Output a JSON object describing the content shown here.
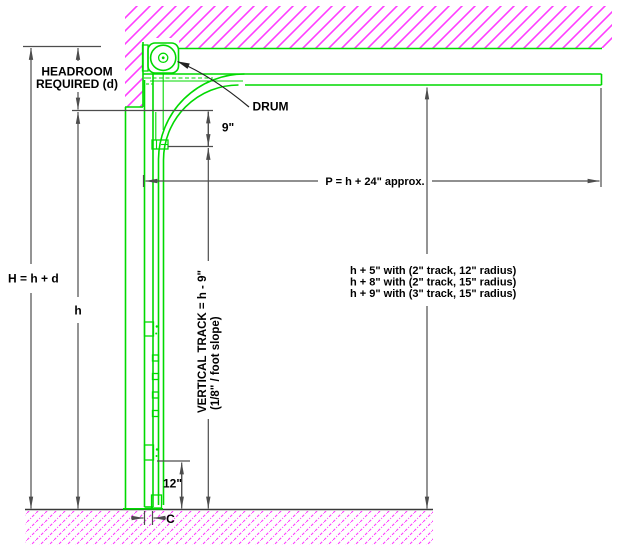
{
  "drawing": {
    "type": "sectional-door-track-headroom-diagram",
    "labels": {
      "headroom1": "HEADROOM",
      "headroom2": "REQUIRED (d)",
      "height_total": "H = h + d",
      "height_opening": "h",
      "drum": "DRUM",
      "top_offset": "9\"",
      "horizontal_track": "P = h + 24\" approx.",
      "note1": "h + 5\" with (2\" track, 12\" radius)",
      "note2": "h + 8\" with (2\" track, 15\" radius)",
      "note3": "h + 9\" with (3\" track, 15\" radius)",
      "vertical_track": "VERTICAL TRACK = h - 9\"",
      "vertical_track_slope": "(1/8\" / foot slope)",
      "bottom_offset": "12\"",
      "clearance": "C"
    },
    "colors": {
      "track_green": "#00d900",
      "wall_hatch_magenta": "#ff3dff",
      "dimension_gray": "#4d4d4d",
      "text_black": "#000000"
    }
  }
}
